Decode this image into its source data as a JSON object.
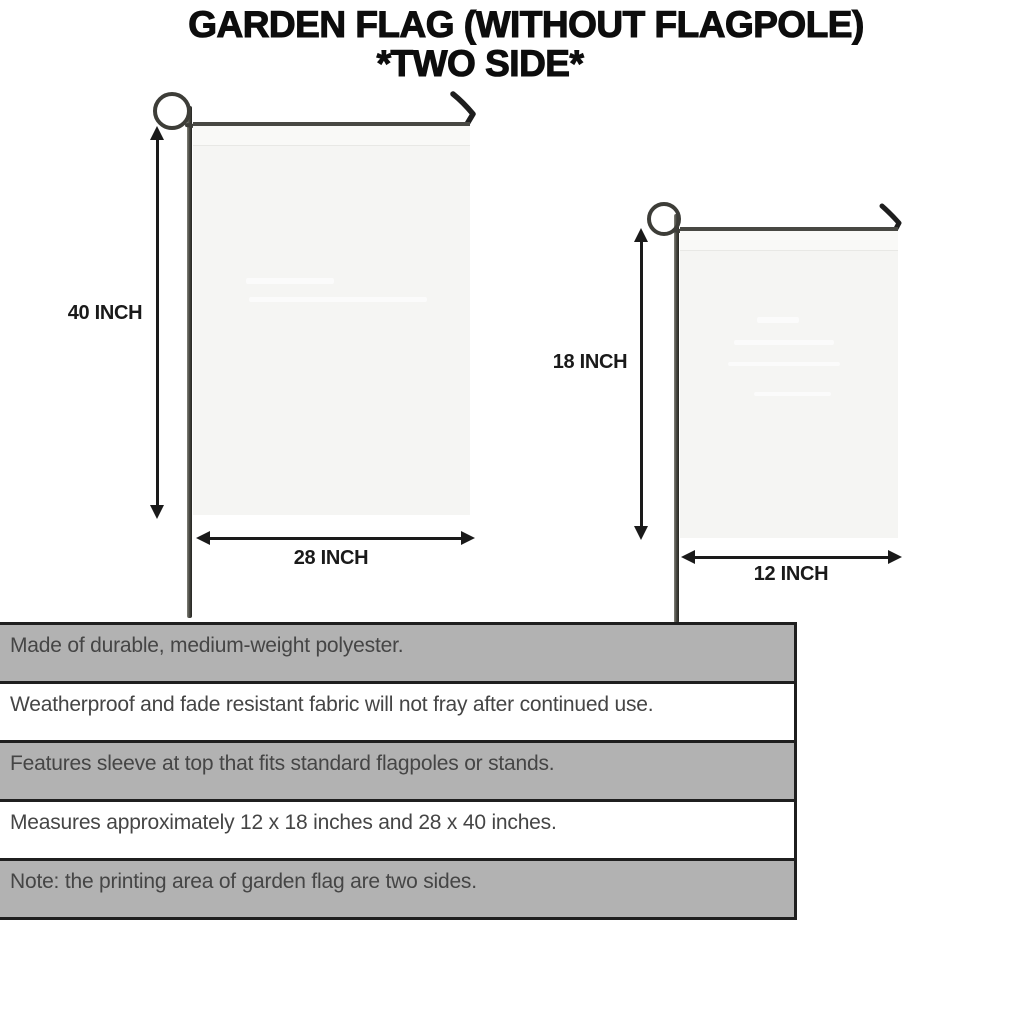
{
  "title": {
    "line1": "GARDEN FLAG (WITHOUT FLAGPOLE)",
    "line2": "*TWO SIDE*"
  },
  "diagram": {
    "large_flag": {
      "height_label": "40 INCH",
      "width_label": "28 INCH"
    },
    "small_flag": {
      "height_label": "18 INCH",
      "width_label": "12 INCH"
    }
  },
  "features": [
    {
      "text": "Made of durable, medium-weight polyester."
    },
    {
      "text": "Weatherproof and fade resistant fabric will not fray after continued use."
    },
    {
      "text": "Features sleeve at top that fits standard flagpoles or stands."
    },
    {
      "text": "Measures approximately 12 x 18 inches and 28 x 40 inches."
    },
    {
      "text": "Note: the printing area of garden flag are two sides."
    }
  ],
  "colors": {
    "title_text": "#0d0d0d",
    "dimension_text": "#1a1a1a",
    "arrow": "#1a1a1a",
    "flag_fabric": "#f5f5f3",
    "pole_dark": "#3d3d38",
    "table_row_gray": "#b2b2b2",
    "table_row_white": "#ffffff",
    "table_border": "#1f1f1f",
    "table_text": "#454545"
  }
}
